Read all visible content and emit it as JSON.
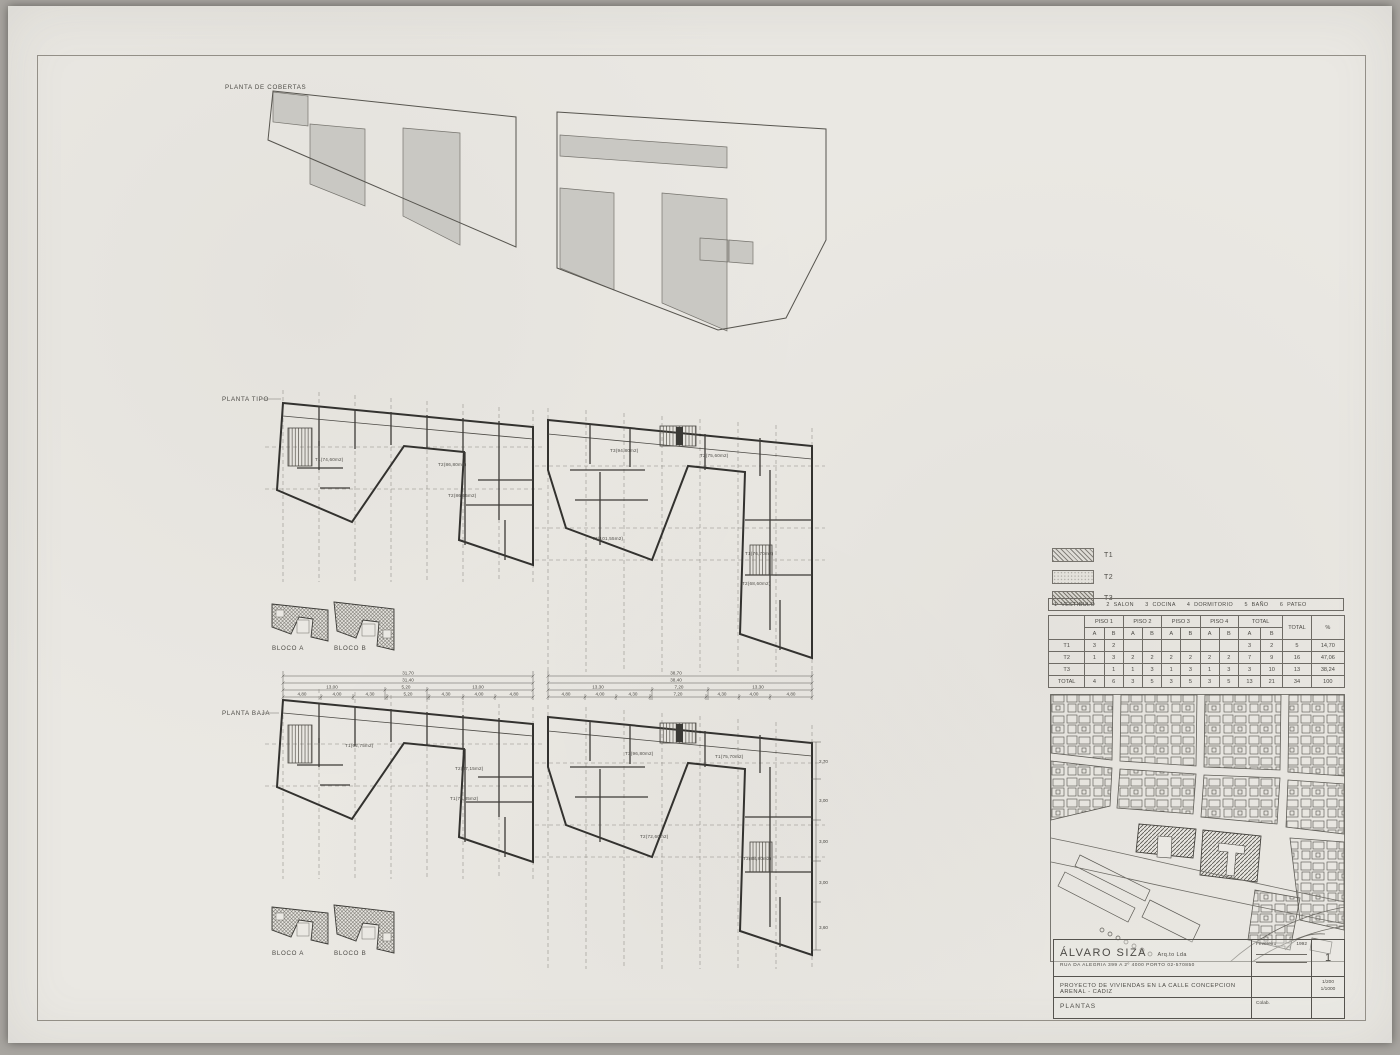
{
  "drawing": {
    "labels": {
      "roof": "PLANTA DE COBERTAS",
      "typical": "PLANTA TIPO",
      "ground": "PLANTA BAJA",
      "block_a": "BLOCO A",
      "block_b": "BLOCO B"
    },
    "units": {
      "tipo_a": [
        "T1(74,60m2)",
        "T2(86,80m2)",
        "T2(86,55m2)"
      ],
      "tipo_b": [
        "T3(94,80m2)",
        "T2(75,60m2)",
        "T3(101,55m2)",
        "T1(76,70m2)",
        "T2(68,60m2)"
      ],
      "baja_a": [
        "T1(62,75m2)",
        "T2(87,15m2)",
        "T1(76,35m2)"
      ],
      "baja_b": [
        "T3(96,80m2)",
        "T1(75,70m2)",
        "T2(72,60m2)",
        "T3(88,80m2)"
      ]
    },
    "dims_a": {
      "total": "31,70",
      "sub": "31,40",
      "thirds": [
        "13,00",
        "5,20",
        "13,00"
      ],
      "segments": [
        "4,80",
        "4,00",
        "4,30",
        "5,20",
        "4,30",
        "4,00",
        "4,80"
      ]
    },
    "dims_b": {
      "total": "38,70",
      "sub": "38,40",
      "thirds": [
        "13,30",
        "7,20",
        "13,30"
      ],
      "segments": [
        "4,80",
        "4,00",
        "4,30",
        "7,20",
        "4,30",
        "4,00",
        "4,80"
      ]
    },
    "dims_b_vertical": [
      "2,70",
      "3,00",
      "3,00",
      "3,00",
      "3,60"
    ]
  },
  "legend": {
    "types": [
      {
        "label": "T1"
      },
      {
        "label": "T2"
      },
      {
        "label": "T3"
      }
    ],
    "rooms": "1  VESTIBULO      2  SALON      3  COCINA      4  DORMITORIO      5  BAÑO      6  PATEO"
  },
  "table": {
    "groups": [
      "PISO 1",
      "PISO 2",
      "PISO 3",
      "PISO 4",
      "TOTAL"
    ],
    "total_label": "TOTAL",
    "pct_label": "%",
    "sub": [
      "A",
      "B"
    ],
    "rows": [
      {
        "label": "T1",
        "cells": [
          "3",
          "2",
          "",
          "",
          "",
          "",
          "",
          "",
          "3",
          "2",
          "5",
          "14,70"
        ]
      },
      {
        "label": "T2",
        "cells": [
          "1",
          "3",
          "2",
          "2",
          "2",
          "2",
          "2",
          "2",
          "7",
          "9",
          "16",
          "47,06"
        ]
      },
      {
        "label": "T3",
        "cells": [
          "",
          "1",
          "1",
          "3",
          "1",
          "3",
          "1",
          "3",
          "3",
          "10",
          "13",
          "38,24"
        ]
      },
      {
        "label": "TOTAL",
        "cells": [
          "4",
          "6",
          "3",
          "5",
          "3",
          "5",
          "3",
          "5",
          "13",
          "21",
          "34",
          "100"
        ]
      }
    ]
  },
  "title_block": {
    "architect": "ÁLVARO SIZA",
    "qualifier": "Arq.to  Lda",
    "address": "RUA DA ALEGRIA  399 A  2º  4000   PORTO   02-570850",
    "date_label": "Fevereiro",
    "date_year": "1992",
    "sheet_number": "1",
    "project": "PROYECTO  DE  VIVIENDAS  EN  LA  CALLE  CONCEPCION  ARENAL  -  CADIZ",
    "scale_1": "1/200",
    "scale_2": "1/1000",
    "sheet_title": "PLANTAS",
    "colab_label": "Colab."
  }
}
